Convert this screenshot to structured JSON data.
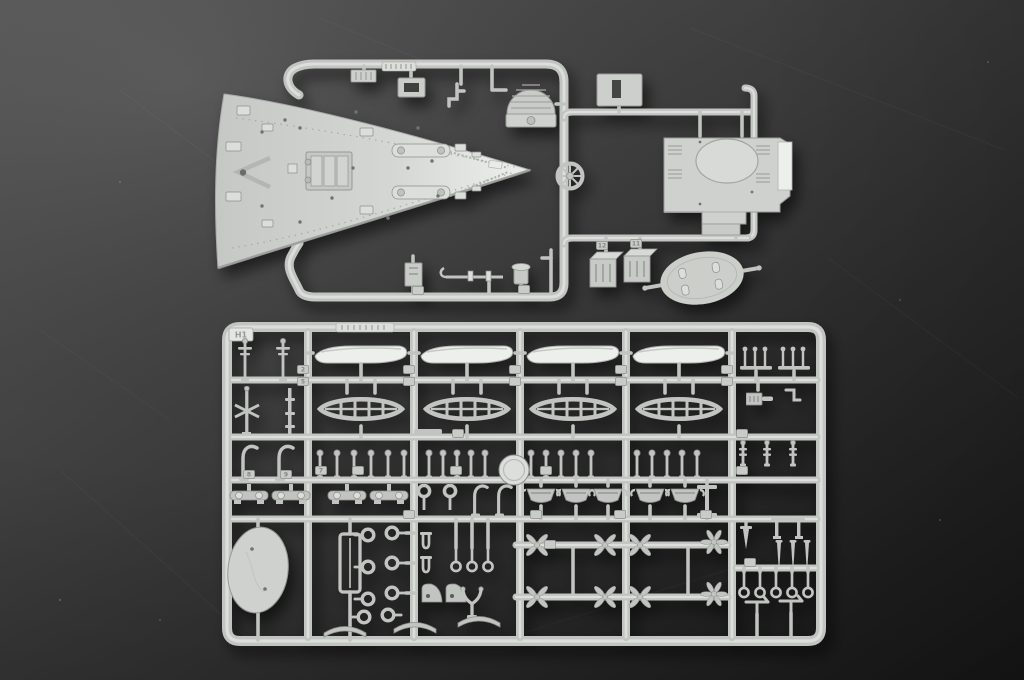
{
  "meta": {
    "type": "photograph",
    "subject": "Light-gray injection-molded plastic model kit sprues of an ocean liner photographed on a dark gray studio backdrop"
  },
  "colors": {
    "bg_a": "#575757",
    "bg_b": "#434343",
    "bg_c": "#2d2d2d",
    "bg_d": "#191919",
    "plastic": "#c2c4c1",
    "plastic_light": "#dcdedb",
    "plastic_dark": "#8d8f8c",
    "plastic_white": "#edefec",
    "deck_a": "#c6c8c5",
    "deck_b": "#d4d6d3",
    "deck_c": "#e9ebe8",
    "tag": "#c9cbc8",
    "hole": "#5a5c59"
  },
  "labels": {
    "sprue_corner": "H1",
    "tag_numbers": [
      "2",
      "5",
      "7",
      "8",
      "9",
      "11",
      "12"
    ]
  },
  "scene": {
    "background": "dark charcoal gradient, lighter at upper left, with faint scratches",
    "upper_sprue": {
      "parts": [
        "pointed forecastle main-deck piece with breakwater, windlass and mooring fittings",
        "superstructure deck block with raised oval skylight and white side wall",
        "dome-shaped ventilation grating",
        "spoked capstan wheel",
        "ribbed vent plate",
        "hatch coaming frame",
        "L-bracket",
        "slotted name plate",
        "two small deckhouse boxes",
        "derrick boom with hook",
        "small winch body",
        "free-lying oval platform with four posts and two side pins"
      ]
    },
    "lower_sprue": {
      "corner_label": "H1",
      "parts": [
        "four white lifeboat hulls",
        "four ribbed open whaleboats",
        "rows of ball-top bollards and stanchions",
        "cargo-winch beds",
        "mooring rings and shackles",
        "four-blade and six-blade propellers",
        "small dinghies with davit hooks",
        "davit arms",
        "mast and spar pieces",
        "large oval platform disc",
        "rectangular skylight frame",
        "flag staffs and eye-bolt pins",
        "benches and T-shaped fittings",
        "curved rocker strips",
        "numbered part tags"
      ]
    }
  }
}
